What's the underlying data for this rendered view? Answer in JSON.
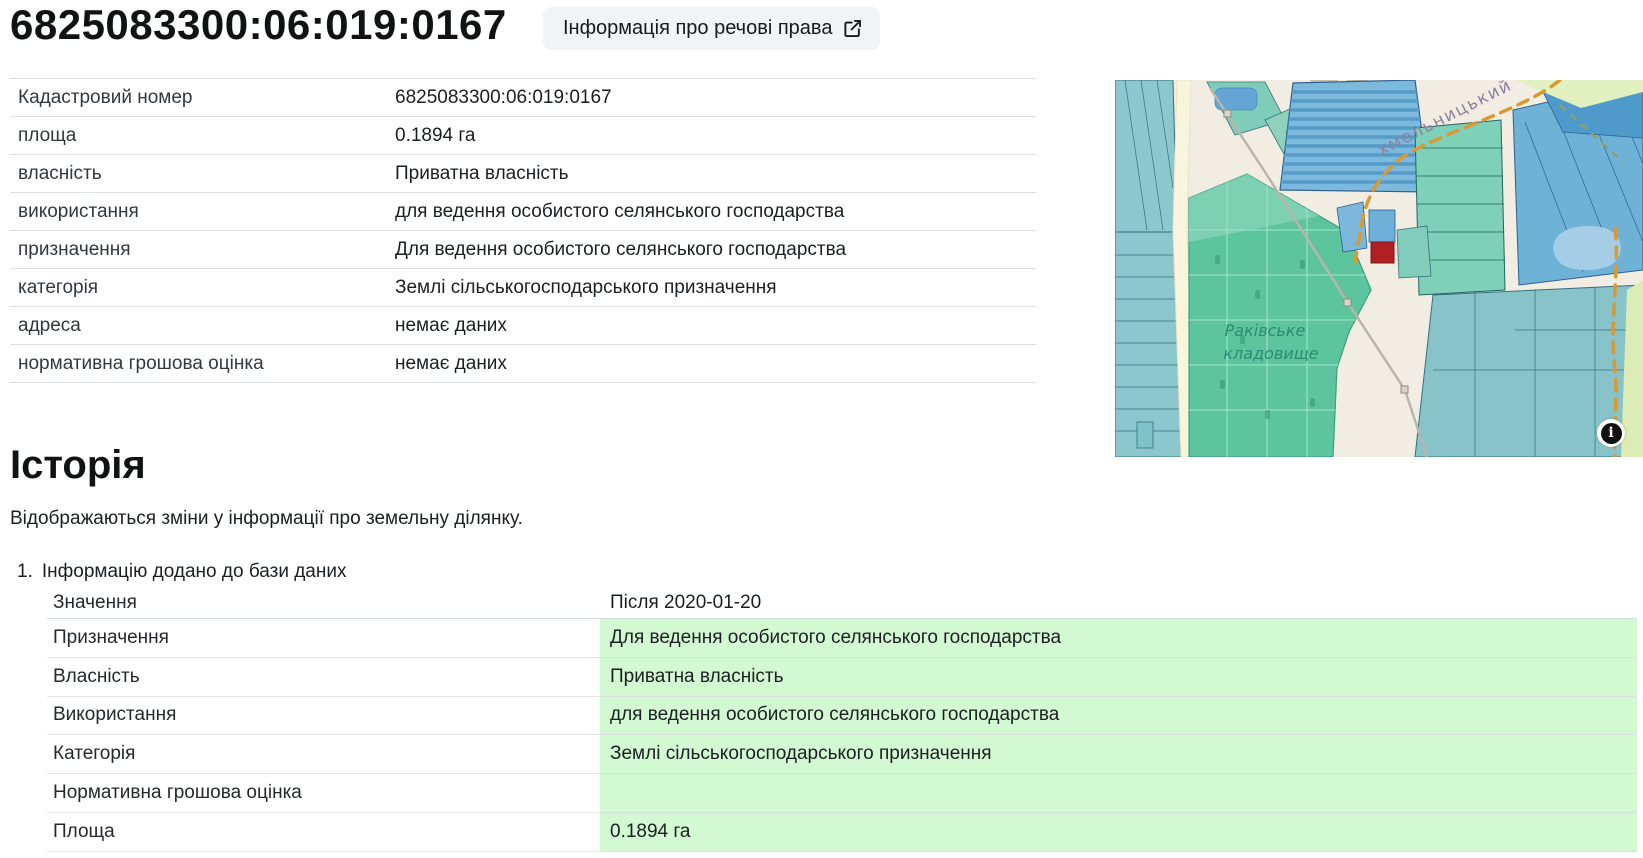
{
  "page": {
    "title": "6825083300:06:019:0167",
    "rights_button_label": "Інформація про речові права",
    "rights_button_icon": "external-link-icon"
  },
  "details_table": {
    "rows": [
      {
        "label": "Кадастровий номер",
        "value": "6825083300:06:019:0167"
      },
      {
        "label": "площа",
        "value": "0.1894 га"
      },
      {
        "label": "власність",
        "value": "Приватна власність"
      },
      {
        "label": "використання",
        "value": "для ведення особистого селянського господарства"
      },
      {
        "label": "призначення",
        "value": "Для ведення особистого селянського господарства"
      },
      {
        "label": "категорія",
        "value": "Землі сільськогосподарського призначення"
      },
      {
        "label": "адреса",
        "value": "немає даних"
      },
      {
        "label": "нормативна грошова оцінка",
        "value": "немає даних"
      }
    ]
  },
  "map": {
    "cemetery_label_line1": "Раківське",
    "cemetery_label_line2": "кладовище",
    "road_label": "хмельницький",
    "attribution_icon": "info-icon",
    "attribution_glyph": "i"
  },
  "history": {
    "heading": "Історія",
    "description": "Відображаються зміни у інформації про земельну ділянку.",
    "entries": [
      {
        "index": "1.",
        "title": "Інформацію додано до бази даних",
        "rows": [
          {
            "label": "Значення",
            "value": "Після 2020-01-20",
            "highlight": false
          },
          {
            "label": "Призначення",
            "value": "Для ведення особистого селянського господарства",
            "highlight": true
          },
          {
            "label": "Власність",
            "value": "Приватна власність",
            "highlight": true
          },
          {
            "label": "Використання",
            "value": "для ведення особистого селянського господарства",
            "highlight": true
          },
          {
            "label": "Категорія",
            "value": "Землі сільськогосподарського призначення",
            "highlight": true
          },
          {
            "label": "Нормативна грошова оцінка",
            "value": "",
            "highlight": true
          },
          {
            "label": "Площа",
            "value": "0.1894 га",
            "highlight": true
          }
        ]
      }
    ]
  },
  "colors": {
    "highlight_green": "#d2f9d2",
    "accent_red": "#b01f24",
    "button_bg": "#f1f3f5"
  }
}
